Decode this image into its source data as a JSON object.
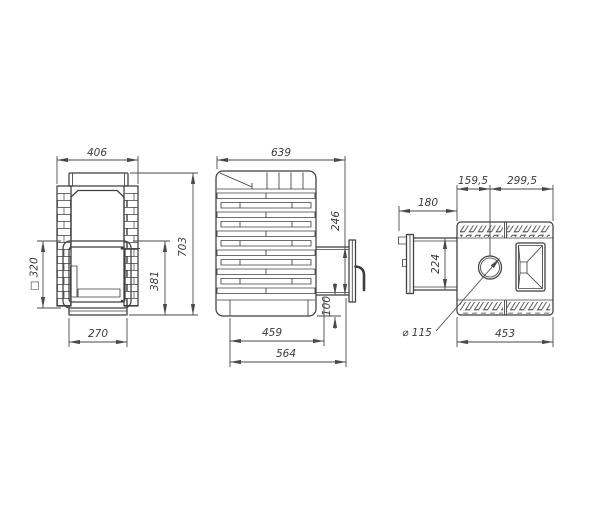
{
  "drawing": {
    "background": "#ffffff",
    "line_color": "#3f3f3f",
    "text_color": "#3b3b3b",
    "views": {
      "front": {
        "label": "front-view",
        "dims": {
          "overall_width": "406",
          "overall_height": "703",
          "door_frame_height": "381",
          "door_size": "□ 320",
          "base_width": "270"
        }
      },
      "side": {
        "label": "side-view",
        "dims": {
          "overall_depth": "639",
          "door_opening_height": "246",
          "door_bottom_to_base": "100",
          "base_depth": "459",
          "max_depth": "564"
        }
      },
      "top": {
        "label": "top-view",
        "dims": {
          "chimney_to_front": "159,5",
          "chimney_to_back": "299,5",
          "tunnel_length": "180",
          "tunnel_width": "224",
          "body_width": "453",
          "chimney_diameter": "⌀ 115"
        }
      }
    }
  }
}
